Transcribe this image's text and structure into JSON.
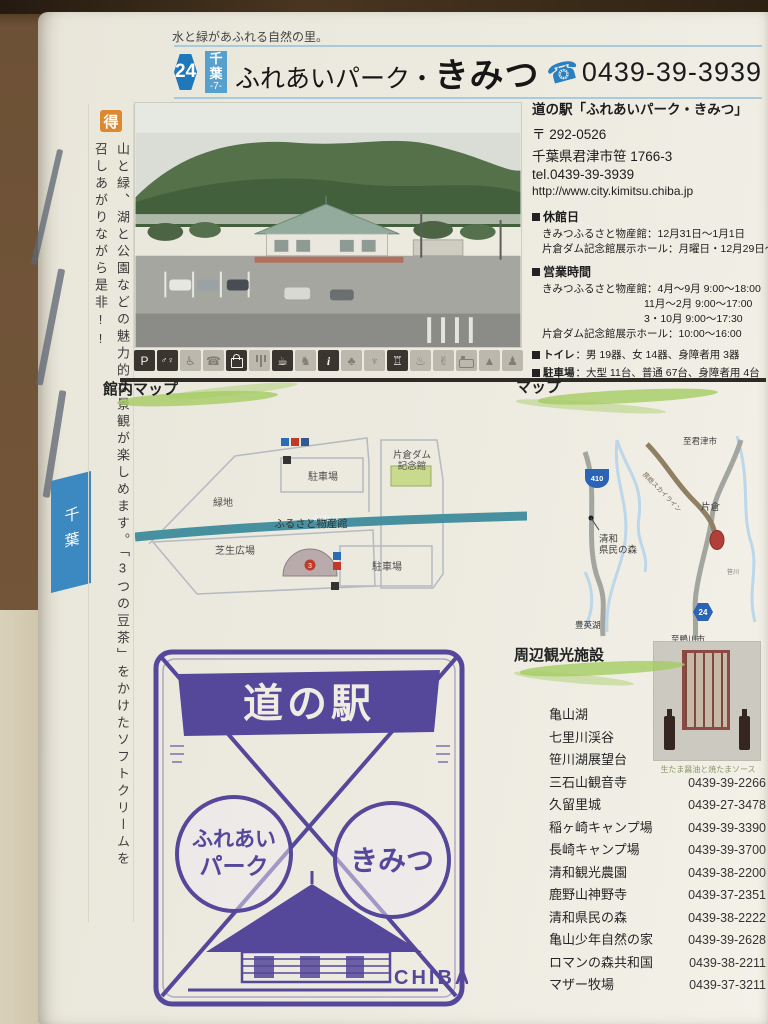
{
  "tagline": "水と緑があふれる自然の里。",
  "header": {
    "number": "24",
    "prefecture": "千葉",
    "prefecture_no": "-7-",
    "name_prefix": "ふれあいパーク・",
    "name_main": "きみつ",
    "phone": "0439-39-3939"
  },
  "side_tab_label": "千葉",
  "sidebar": {
    "badge": "得",
    "text": "山と緑、湖と公園などの魅力的な景観が楽しめます。「3つの豆茶」をかけたソフトクリームを召しあがりながら是非!!"
  },
  "info": {
    "name": "道の駅「ふれあいパーク・きみつ」",
    "postal": "〒 292-0526",
    "address": "千葉県君津市笹 1766-3",
    "tel": "tel.0439-39-3939",
    "url": "http://www.city.kimitsu.chiba.jp",
    "closed_label": "休館日",
    "closed_lines": [
      "きみつふるさと物産館：12月31日～1月1日",
      "片倉ダム記念館展示ホール：月曜日・12月29日～1月1日"
    ],
    "hours_label": "営業時間",
    "hours_lines": [
      "きみつふるさと物産館：4月～9月 9:00～18:00",
      "11月～2月 9:00～17:00",
      "3・10月 9:00～17:30",
      "片倉ダム記念館展示ホール：10:00～16:00"
    ],
    "toilet_label": "トイレ",
    "toilet_value": "：男 19器、女 14器、身障者用 3器",
    "parking_label": "駐車場",
    "parking_value": "：大型 11台、普通 67台、身障者用 4台"
  },
  "facility_icons": [
    {
      "name": "parking",
      "active": true
    },
    {
      "name": "restroom",
      "active": true
    },
    {
      "name": "wheelchair",
      "active": false
    },
    {
      "name": "public-phone",
      "active": false
    },
    {
      "name": "shopping",
      "active": true
    },
    {
      "name": "restaurant",
      "active": false
    },
    {
      "name": "cafe",
      "active": true
    },
    {
      "name": "baby-room",
      "active": false
    },
    {
      "name": "information",
      "active": true
    },
    {
      "name": "park-green",
      "active": false
    },
    {
      "name": "fountain",
      "active": false
    },
    {
      "name": "museum",
      "active": true
    },
    {
      "name": "hot-spring",
      "active": false
    },
    {
      "name": "experience",
      "active": false
    },
    {
      "name": "lodging",
      "active": false
    },
    {
      "name": "camping",
      "active": false
    },
    {
      "name": "playground",
      "active": false
    }
  ],
  "facility_map": {
    "heading": "館内マップ",
    "road_label": "県道24号",
    "green_space": "緑地",
    "parking_top": "駐車場",
    "dam_hall_1": "片倉ダム",
    "dam_hall_2": "記念館",
    "bussankan": "ふるさと物産館",
    "bussankan_no": "3",
    "lawn": "芝生広場",
    "parking_bottom": "駐車場"
  },
  "area_map": {
    "heading": "マップ",
    "route_410": "410",
    "route_24": "24",
    "to_kimitsu": "至君津市",
    "skyline_road": "房総スカイライン",
    "katakura": "片倉",
    "seiwa_1": "清和",
    "seiwa_2": "県民の森",
    "lake": "豊英湖",
    "to_kamogawa": "至鴨川市",
    "river": "笹川"
  },
  "stamp": {
    "banner": "道の駅",
    "circle_left_1": "ふれあい",
    "circle_left_2": "パーク",
    "circle_right": "きみつ",
    "country": "CHIBA"
  },
  "sights": {
    "heading": "周辺観光施設",
    "product_caption": "生たま醤油と焼たまソース",
    "items": [
      {
        "name": "亀山湖",
        "tel": ""
      },
      {
        "name": "七里川渓谷",
        "tel": ""
      },
      {
        "name": "笹川湖展望台",
        "tel": ""
      },
      {
        "name": "三石山観音寺",
        "tel": "0439-39-2266"
      },
      {
        "name": "久留里城",
        "tel": "0439-27-3478"
      },
      {
        "name": "稲ヶ崎キャンプ場",
        "tel": "0439-39-3390"
      },
      {
        "name": "長崎キャンプ場",
        "tel": "0439-39-3700"
      },
      {
        "name": "清和観光農園",
        "tel": "0439-38-2200"
      },
      {
        "name": "鹿野山神野寺",
        "tel": "0439-37-2351"
      },
      {
        "name": "清和県民の森",
        "tel": "0439-38-2222"
      },
      {
        "name": "亀山少年自然の家",
        "tel": "0439-39-2628"
      },
      {
        "name": "ロマンの森共和国",
        "tel": "0439-38-2211"
      },
      {
        "name": "マザー牧場",
        "tel": "0439-37-3211"
      }
    ]
  }
}
